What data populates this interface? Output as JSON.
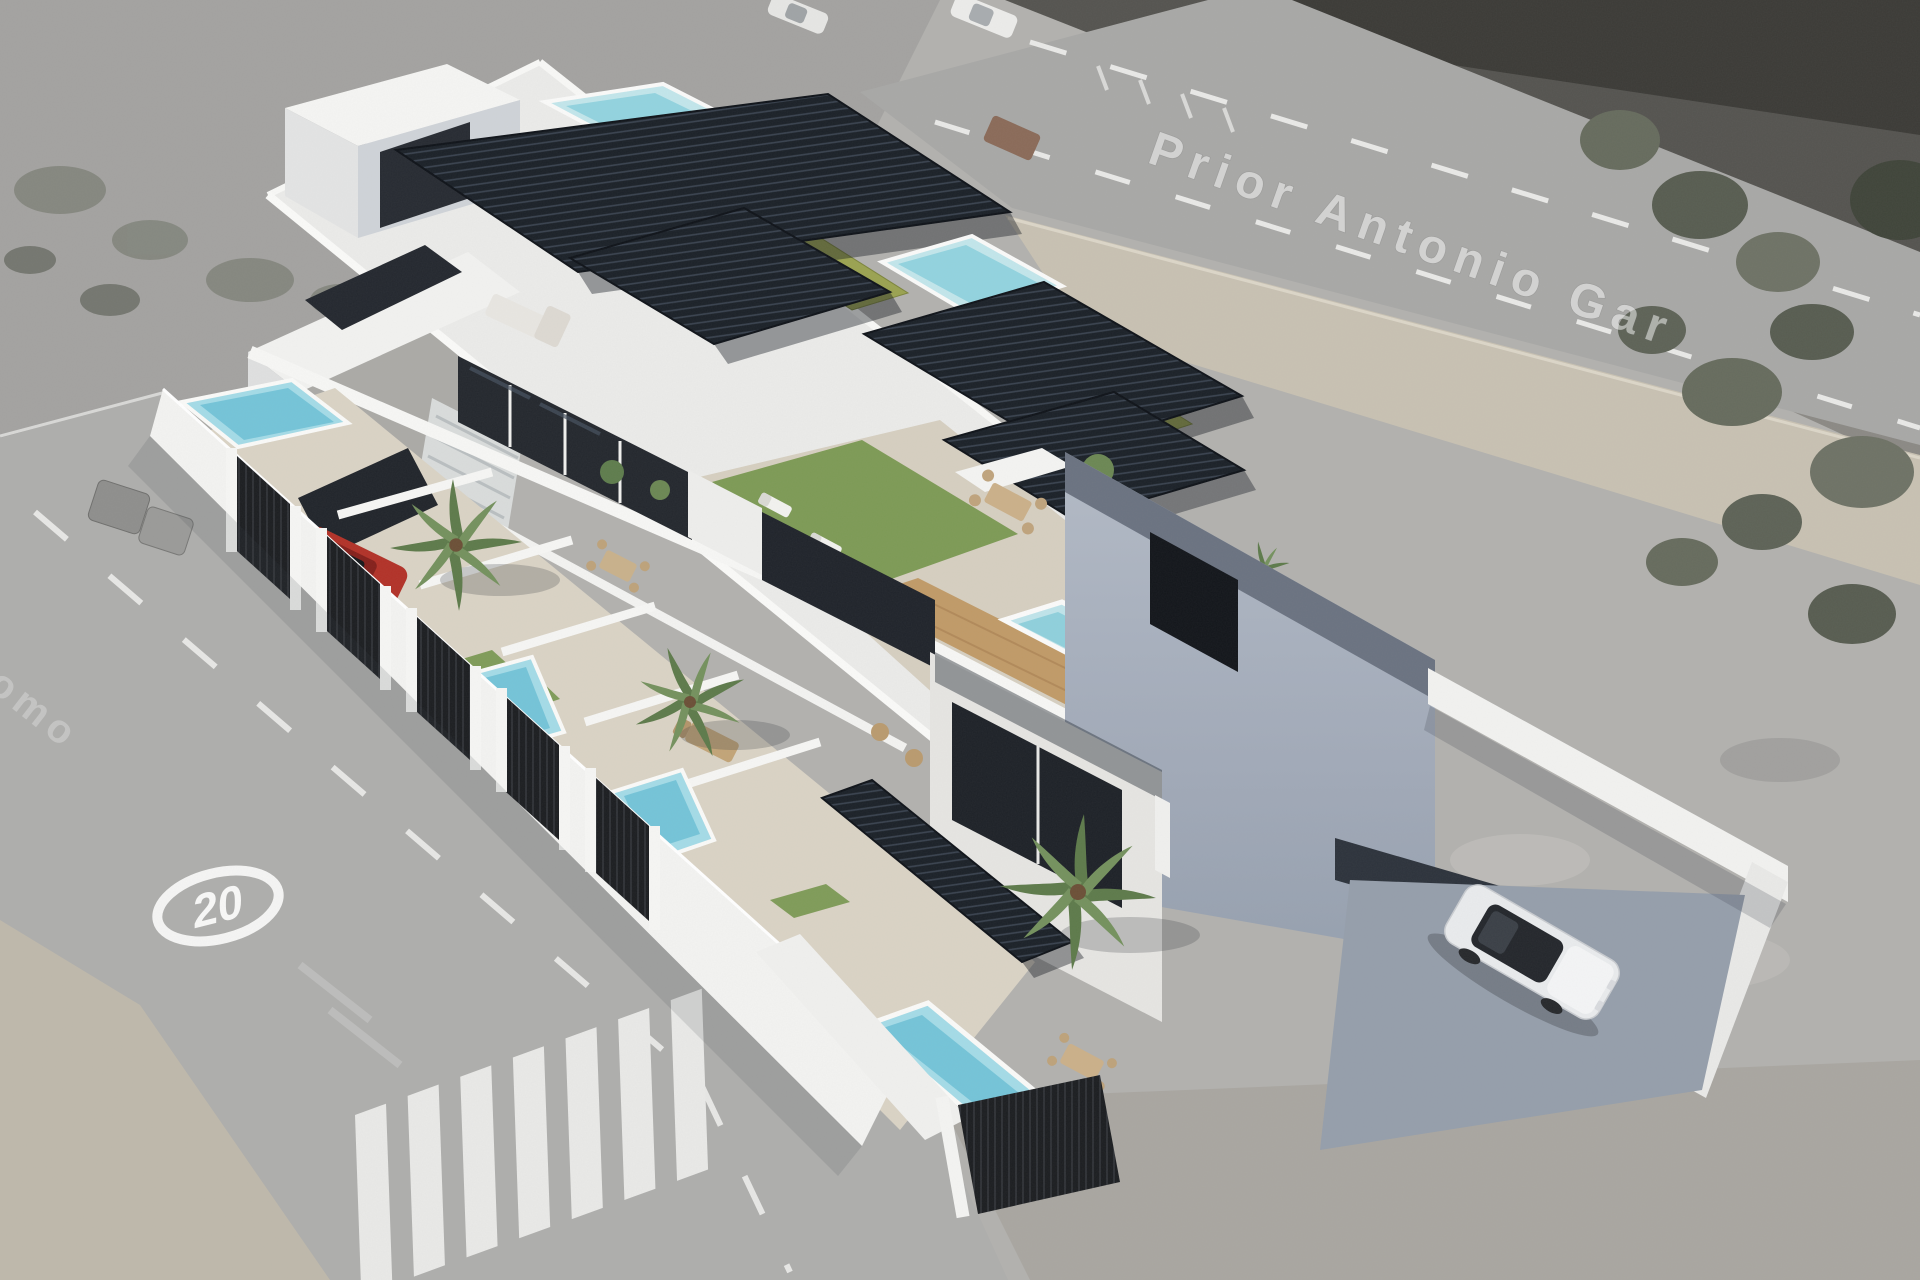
{
  "scene": {
    "description": "Aerial 3D render of a row of modern white terraced houses with rooftop solariums, pergolas and pools, composited on a grayscale aerial photo",
    "watermark_street": "Prior Antonio Gar",
    "watermark_street_partial": "omo",
    "road_marking_speed": "20"
  },
  "palette": {
    "background_gray": "#b2b1ae",
    "asphalt_road": "#aeaeac",
    "sidewalk_beige": "#c8c1b2",
    "building_white": "#f1f1ef",
    "facade_shadow_blue": "#a7afbd",
    "pergola_dark": "#1a2027",
    "pool_cyan": "#a8dce8",
    "roof_lawn_olive": "#9aa250",
    "garden_lawn_green": "#7d9a55",
    "deck_wood": "#c09a67",
    "fence_black": "#1b1d20",
    "car_white": "#e9ebed",
    "car_red": "#b23127"
  }
}
